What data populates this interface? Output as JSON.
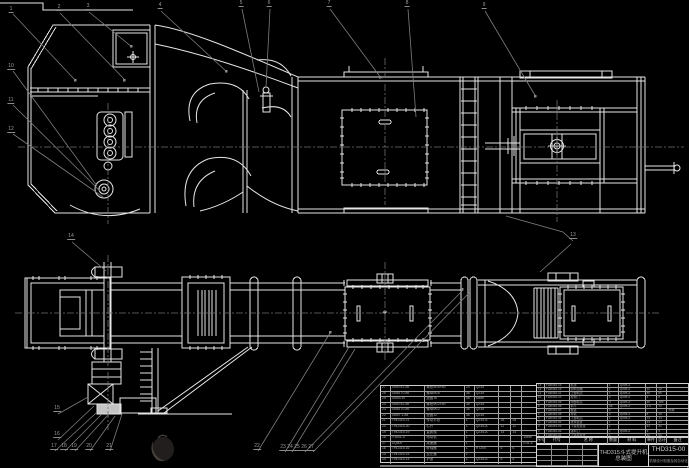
{
  "sheet": {
    "background": "#000000",
    "line_color": "#e6e6e6",
    "leader_color": "#7d7d7d",
    "centerline_color": "#707070",
    "stamp_colors": [
      "#221e1d",
      "#474038"
    ]
  },
  "title_block": {
    "product_title": "THD315斗式提升机",
    "drawing_type": "总装图",
    "drawing_no": "THD315-00",
    "org_line": "机械设计制造及其自动化"
  },
  "bom": {
    "headers": [
      "序号",
      "代号",
      "名 称",
      "数量",
      "材 料",
      "单件",
      "总计",
      "备注"
    ],
    "right_rows": [
      [
        "13",
        "THD315-13",
        "机罩",
        "1",
        "Q235-A",
        "",
        "",
        ""
      ],
      [
        "12",
        "THD315-12",
        "卸料溜槽",
        "1",
        "Q235-A",
        "12",
        "12",
        ""
      ],
      [
        "11",
        "THD315-11",
        "上部机壳",
        "1",
        "Q235-A",
        "86",
        "86",
        ""
      ],
      [
        "10",
        "THD315-10",
        "检视门",
        "2",
        "Q235-A",
        "4",
        "8",
        ""
      ],
      [
        "9",
        "THD315-09",
        "中部机壳",
        "4",
        "Q235-A",
        "45",
        "180",
        ""
      ],
      [
        "8",
        "THD315-08",
        "料斗",
        "38",
        "Q235-A",
        "1.9",
        "72",
        ""
      ],
      [
        "7",
        "THD315-07",
        "板链",
        "2",
        "",
        "",
        "",
        "外购"
      ],
      [
        "6",
        "THD315-06",
        "导轨",
        "2",
        "Q235-A",
        "8",
        "16",
        ""
      ],
      [
        "5",
        "THD315-05",
        "下部机壳",
        "1",
        "Q235-A",
        "74",
        "74",
        ""
      ],
      [
        "4",
        "THD315-04",
        "张紧装置",
        "1",
        "",
        "23",
        "23",
        ""
      ],
      [
        "3",
        "THD315-03",
        "下链轮装置",
        "1",
        "",
        "31",
        "31",
        ""
      ],
      [
        "2",
        "THD315-02",
        "进料口",
        "1",
        "Q235-A",
        "9",
        "9",
        ""
      ],
      [
        "1",
        "THD315-01",
        "上链轮装置",
        "1",
        "",
        "52",
        "52",
        ""
      ]
    ],
    "left_rows": [
      [
        "27",
        "GB5782-86",
        "螺栓M16×50",
        "24",
        "Q235",
        "",
        "",
        ""
      ],
      [
        "26",
        "GB6170-86",
        "螺母M16",
        "48",
        "Q235",
        "",
        "",
        ""
      ],
      [
        "25",
        "GB93-87",
        "垫圈16",
        "48",
        "65Mn",
        "",
        "",
        ""
      ],
      [
        "24",
        "GB5782-86",
        "螺栓M12×40",
        "36",
        "Q235",
        "",
        "",
        ""
      ],
      [
        "23",
        "GB6170-86",
        "螺母M12",
        "36",
        "Q235",
        "",
        "",
        ""
      ],
      [
        "22",
        "GB97.1-85",
        "垫圈12",
        "36",
        "Q235",
        "",
        "",
        ""
      ],
      [
        "21",
        "THD315-21",
        "传动平台",
        "1",
        "Q235-A",
        "28",
        "28",
        ""
      ],
      [
        "20",
        "THD315-20",
        "栏杆",
        "1",
        "Q235-A",
        "11",
        "11",
        ""
      ],
      [
        "19",
        "THD315-19",
        "直爬梯",
        "1",
        "Q235-A",
        "14",
        "14",
        ""
      ],
      [
        "18",
        "Y160L-4",
        "电动机",
        "1",
        "",
        "",
        "",
        "15kW"
      ],
      [
        "17",
        "ZQ500",
        "减速器",
        "1",
        "",
        "",
        "",
        "i=31.5"
      ],
      [
        "16",
        "THD315-16",
        "联轴器",
        "1",
        "HT200",
        "6",
        "6",
        ""
      ],
      [
        "15",
        "THD315-15",
        "逆止器",
        "1",
        "",
        "",
        "",
        ""
      ],
      [
        "14",
        "THD315-14",
        "护罩",
        "1",
        "Q235-A",
        "5",
        "5",
        ""
      ]
    ]
  },
  "callouts": [
    {
      "label": "1",
      "x": 11,
      "y": 13
    },
    {
      "label": "2",
      "x": 59,
      "y": 11
    },
    {
      "label": "3",
      "x": 88,
      "y": 10
    },
    {
      "label": "4",
      "x": 160,
      "y": 9
    },
    {
      "label": "5",
      "x": 241,
      "y": 7
    },
    {
      "label": "6",
      "x": 269,
      "y": 7
    },
    {
      "label": "7",
      "x": 329,
      "y": 7
    },
    {
      "label": "8",
      "x": 407,
      "y": 7
    },
    {
      "label": "9",
      "x": 484,
      "y": 9
    },
    {
      "label": "10",
      "x": 11,
      "y": 70
    },
    {
      "label": "11",
      "x": 11,
      "y": 104
    },
    {
      "label": "12",
      "x": 11,
      "y": 133
    },
    {
      "label": "13",
      "x": 573,
      "y": 239
    },
    {
      "label": "14",
      "x": 71,
      "y": 240
    },
    {
      "label": "15",
      "x": 57,
      "y": 412
    },
    {
      "label": "16",
      "x": 57,
      "y": 438
    },
    {
      "label": "17",
      "x": 54,
      "y": 450
    },
    {
      "label": "18",
      "x": 64,
      "y": 450
    },
    {
      "label": "19",
      "x": 74,
      "y": 450
    },
    {
      "label": "20",
      "x": 89,
      "y": 450
    },
    {
      "label": "21",
      "x": 109,
      "y": 450
    },
    {
      "label": "22",
      "x": 257,
      "y": 450
    },
    {
      "label": "23",
      "x": 283,
      "y": 451
    },
    {
      "label": "24",
      "x": 290,
      "y": 451
    },
    {
      "label": "25",
      "x": 297,
      "y": 451
    },
    {
      "label": "26",
      "x": 304,
      "y": 451
    },
    {
      "label": "27",
      "x": 311,
      "y": 451
    }
  ],
  "layout": {
    "left_table": {
      "x": 380,
      "y": 385,
      "w": 157,
      "rowH": 5.57,
      "font": 3.4,
      "cols": [
        10,
        35,
        40,
        10,
        25,
        12,
        11,
        14
      ]
    },
    "right_table": {
      "x": 536,
      "y": 383,
      "w": 153,
      "rowH": 4.15,
      "font": 3.0,
      "cols": [
        8,
        25,
        39,
        11,
        27,
        12,
        10,
        21
      ]
    },
    "header_row": {
      "x": 536,
      "y": 437,
      "w": 153,
      "rowH": 7,
      "font": 4.0,
      "cols": [
        8,
        25,
        39,
        11,
        27,
        12,
        10,
        21
      ]
    }
  }
}
